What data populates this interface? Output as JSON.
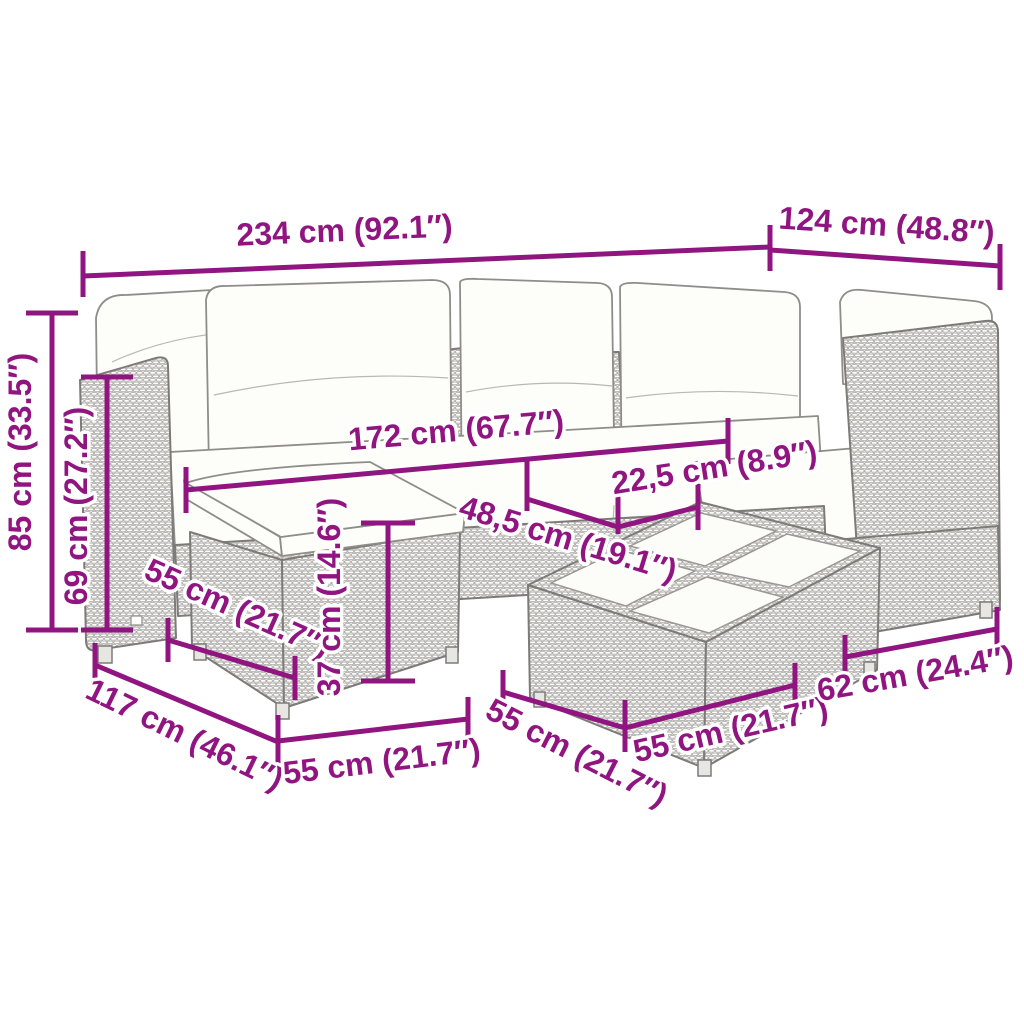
{
  "diagram": {
    "title": "7-piece poly rattan garden lounge set — dimension diagram",
    "colors": {
      "dimension_accent": "#901581",
      "outline_gray": "#7d7b78",
      "wicker_fill": "#f4f3f1",
      "cushion_white": "#fdfdfa",
      "background": "#ffffff"
    },
    "parts": {
      "sofa": "corner sofa with back cushions",
      "footstool": "footstool with cushion",
      "table": "coffee table with glass top tiles",
      "corner_seat": "right corner seat"
    },
    "dimensions": {
      "total_length": "234 cm (92.1″)",
      "corner_section_depth": "124 cm (48.8″)",
      "total_height": "85 cm (33.5″)",
      "frame_height": "69 cm (27.2″)",
      "sofa_inner_length": "172 cm (67.7″)",
      "glass_tile_width": "22,5 cm (8.9″)",
      "tabletop_edge": "48,5 cm (19.1″)",
      "footstool_depth": "55 cm (21.7″)",
      "chaise_total_depth": "117 cm (46.1″)",
      "footstool_width": "55 cm (21.7″)",
      "table_height": "37 cm (14.6″)",
      "table_depth": "55 cm (21.7″)",
      "table_width": "55 cm (21.7″)",
      "corner_seat_width": "62 cm (24.4″)"
    }
  }
}
